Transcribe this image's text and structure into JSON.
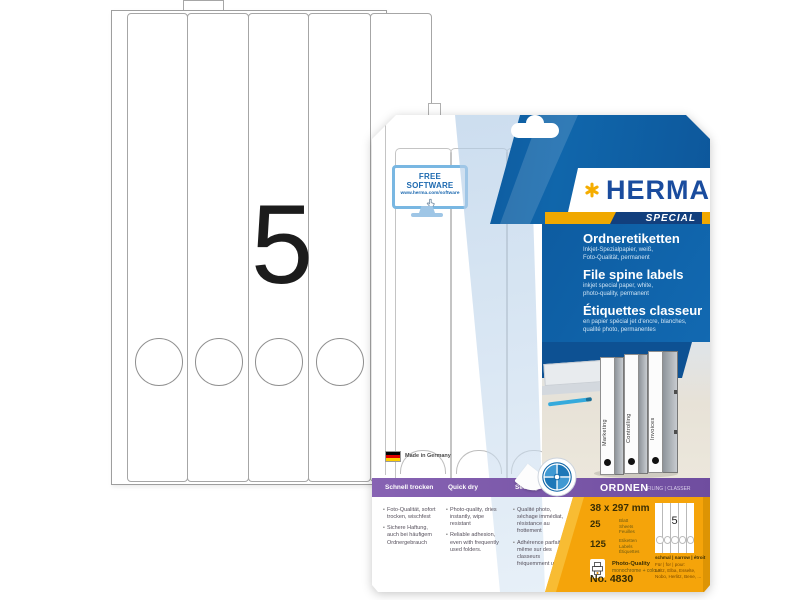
{
  "colors": {
    "herma_yellow": "#f5ad00",
    "herma_blue": "#1068b0",
    "logo_blue": "#1a4c9e",
    "purple_band": "#7a57a8",
    "orange_panel": "#f5a40a"
  },
  "sheet": {
    "big_number": "5"
  },
  "package": {
    "free_software": {
      "title": "FREE SOFTWARE",
      "url": "www.herma.com/software"
    },
    "brand": {
      "name": "HERMA",
      "special": "SPECIAL"
    },
    "product_titles": [
      {
        "title": "Ordneretiketten",
        "subtitle": "Inkjet-Spezialpapier, weiß,\nFoto-Qualität, permanent"
      },
      {
        "title": "File spine labels",
        "subtitle": "inkjet special paper, white,\nphoto-quality, permanent"
      },
      {
        "title": "Étiquettes classeur",
        "subtitle": "en papier spécial jet d'encre, blanches,\nqualité photo, permanentes"
      }
    ],
    "binders": [
      {
        "label": "Marketing"
      },
      {
        "label": "Controlling"
      },
      {
        "label": "Invoices"
      }
    ],
    "made_in": "Made in Germany",
    "feature_columns": [
      {
        "header": "Schnell trocken",
        "items": [
          {
            "text": "Foto-Qualität, sofort trocken, wischfest"
          },
          {
            "text": "Sichere Haftung, auch bei häufigem Ordnergebrauch"
          }
        ]
      },
      {
        "header": "Quick dry",
        "items": [
          {
            "text": "Photo-quality, dries instantly, wipe resistant"
          },
          {
            "text": "Reliable adhesion, even with frequently used folders."
          }
        ]
      },
      {
        "header": "Séchage rapide",
        "items": [
          {
            "text": "Qualité photo, séchage immédiat, résistance au frottement"
          },
          {
            "text": "Adhérence parfaite même sur des classeurs fréquemment utilisés"
          }
        ]
      }
    ],
    "category": {
      "label": "ORDNEN",
      "translations": "FILING | CLASSER"
    },
    "specs": {
      "size": "38 x 297 mm",
      "sheets_count": "25",
      "sheets_label": "Blatt\nSheets\nFeuilles",
      "labels_count": "125",
      "labels_label": "Etiketten\nLabels\nÉtiquettes",
      "quality": "Photo-Quality",
      "quality_sub": "monochrome + colour",
      "order_number": "No. 4830",
      "mini_number": "5",
      "width_class": "schmal | narrow | étroit",
      "for_label": "Für | for | pour:",
      "for_brands": "Leitz, Elba, Esselte, Nobo, Herlitz, Bene, ..."
    }
  }
}
